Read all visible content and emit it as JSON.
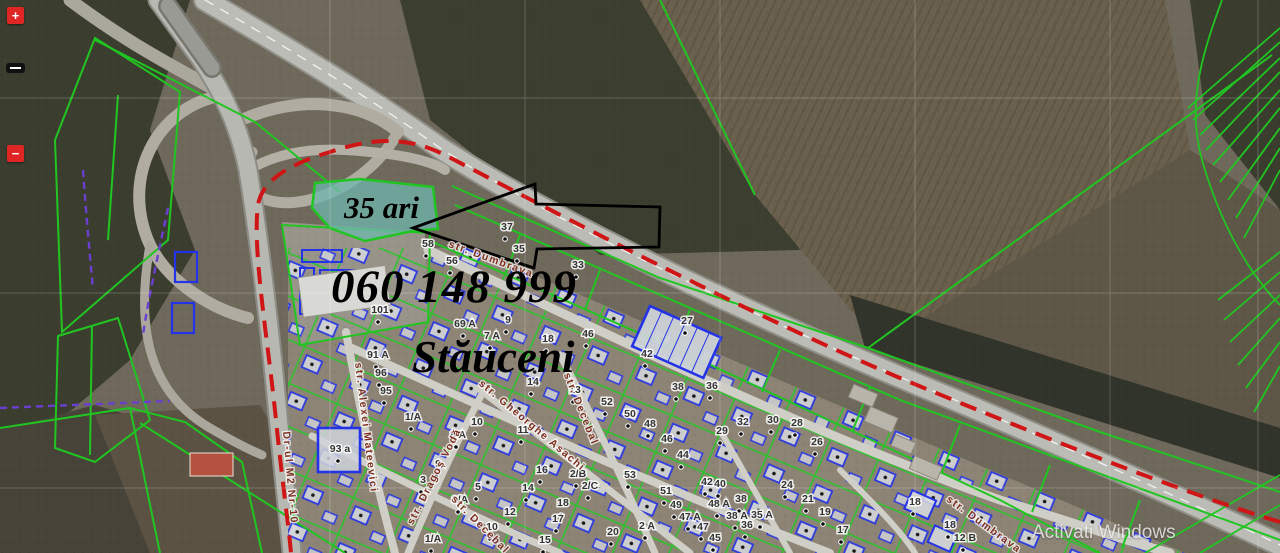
{
  "map": {
    "area_label": "35 ari",
    "phone_number": "060 148 999",
    "town_name": "Stăuceni",
    "watermark": "Activati Windows",
    "controls": {
      "zoom_in": "+",
      "zoom_out": "−"
    },
    "colors": {
      "cadastral_green": "#21c521",
      "building_blue": "#2433e8",
      "boundary_red": "#cf1515",
      "boundary_purple": "#6a3fd0",
      "highlight_teal": "#6fb7ae",
      "street_label": "#7d2f1f"
    },
    "street_labels": [
      {
        "text": "str. Dumbrava",
        "x": 490,
        "y": 262,
        "rot": 20
      },
      {
        "text": "str. Dumbrava",
        "x": 982,
        "y": 527,
        "rot": 36
      },
      {
        "text": "str. Alexei Mateevici",
        "x": 363,
        "y": 428,
        "rot": 83
      },
      {
        "text": "str. Dragoș Vodă",
        "x": 437,
        "y": 478,
        "rot": -63
      },
      {
        "text": "str. Gheorghe Asachi",
        "x": 530,
        "y": 428,
        "rot": 40
      },
      {
        "text": "str. Decebal",
        "x": 578,
        "y": 410,
        "rot": 68
      },
      {
        "text": "str. Decebal",
        "x": 478,
        "y": 527,
        "rot": 45
      },
      {
        "text": "Dr-ul M2 Nr-10",
        "x": 287,
        "y": 478,
        "rot": 85
      }
    ],
    "parcel_labels": [
      {
        "text": "58",
        "x": 428,
        "y": 247
      },
      {
        "text": "56",
        "x": 452,
        "y": 264
      },
      {
        "text": "37",
        "x": 507,
        "y": 230
      },
      {
        "text": "35",
        "x": 519,
        "y": 252
      },
      {
        "text": "33",
        "x": 578,
        "y": 268
      },
      {
        "text": "27",
        "x": 687,
        "y": 324
      },
      {
        "text": "42",
        "x": 647,
        "y": 357
      },
      {
        "text": "38",
        "x": 678,
        "y": 390
      },
      {
        "text": "36",
        "x": 712,
        "y": 389
      },
      {
        "text": "101",
        "x": 380,
        "y": 313
      },
      {
        "text": "69 A",
        "x": 465,
        "y": 327
      },
      {
        "text": "7 A",
        "x": 492,
        "y": 339
      },
      {
        "text": "9",
        "x": 508,
        "y": 323
      },
      {
        "text": "18",
        "x": 548,
        "y": 342
      },
      {
        "text": "46",
        "x": 588,
        "y": 337
      },
      {
        "text": "91 A",
        "x": 378,
        "y": 358
      },
      {
        "text": "96",
        "x": 381,
        "y": 376
      },
      {
        "text": "95",
        "x": 386,
        "y": 394
      },
      {
        "text": "93 a",
        "x": 340,
        "y": 452
      },
      {
        "text": "1/A",
        "x": 413,
        "y": 420
      },
      {
        "text": "10",
        "x": 477,
        "y": 425
      },
      {
        "text": "8 A",
        "x": 458,
        "y": 438
      },
      {
        "text": "9",
        "x": 438,
        "y": 467
      },
      {
        "text": "5",
        "x": 478,
        "y": 490
      },
      {
        "text": "3/A",
        "x": 460,
        "y": 503
      },
      {
        "text": "3",
        "x": 423,
        "y": 483
      },
      {
        "text": "1/A",
        "x": 433,
        "y": 542
      },
      {
        "text": "14",
        "x": 533,
        "y": 385
      },
      {
        "text": "13",
        "x": 575,
        "y": 393
      },
      {
        "text": "52",
        "x": 607,
        "y": 405
      },
      {
        "text": "50",
        "x": 630,
        "y": 417
      },
      {
        "text": "48",
        "x": 650,
        "y": 427
      },
      {
        "text": "46",
        "x": 667,
        "y": 442
      },
      {
        "text": "44",
        "x": 683,
        "y": 458
      },
      {
        "text": "29",
        "x": 722,
        "y": 434
      },
      {
        "text": "32",
        "x": 743,
        "y": 425
      },
      {
        "text": "30",
        "x": 773,
        "y": 423
      },
      {
        "text": "28",
        "x": 797,
        "y": 426
      },
      {
        "text": "26",
        "x": 817,
        "y": 445
      },
      {
        "text": "11",
        "x": 523,
        "y": 433
      },
      {
        "text": "16",
        "x": 542,
        "y": 473
      },
      {
        "text": "14",
        "x": 528,
        "y": 491
      },
      {
        "text": "12",
        "x": 510,
        "y": 515
      },
      {
        "text": "2/B",
        "x": 578,
        "y": 477
      },
      {
        "text": "2/C",
        "x": 590,
        "y": 489
      },
      {
        "text": "18",
        "x": 563,
        "y": 506
      },
      {
        "text": "17",
        "x": 558,
        "y": 522
      },
      {
        "text": "15",
        "x": 545,
        "y": 543
      },
      {
        "text": "53",
        "x": 630,
        "y": 478
      },
      {
        "text": "51",
        "x": 666,
        "y": 494
      },
      {
        "text": "49",
        "x": 676,
        "y": 508
      },
      {
        "text": "42",
        "x": 707,
        "y": 485
      },
      {
        "text": "40",
        "x": 720,
        "y": 487
      },
      {
        "text": "48 A",
        "x": 719,
        "y": 507
      },
      {
        "text": "38",
        "x": 741,
        "y": 502
      },
      {
        "text": "47 A",
        "x": 690,
        "y": 520
      },
      {
        "text": "38 A",
        "x": 737,
        "y": 519
      },
      {
        "text": "36",
        "x": 747,
        "y": 528
      },
      {
        "text": "35 A",
        "x": 762,
        "y": 518
      },
      {
        "text": "24",
        "x": 787,
        "y": 488
      },
      {
        "text": "21",
        "x": 808,
        "y": 502
      },
      {
        "text": "19",
        "x": 825,
        "y": 515
      },
      {
        "text": "17",
        "x": 843,
        "y": 533
      },
      {
        "text": "47",
        "x": 703,
        "y": 530
      },
      {
        "text": "45",
        "x": 715,
        "y": 541
      },
      {
        "text": "20",
        "x": 613,
        "y": 535
      },
      {
        "text": "2 A",
        "x": 647,
        "y": 529
      },
      {
        "text": "10",
        "x": 492,
        "y": 530
      },
      {
        "text": "18",
        "x": 915,
        "y": 505
      },
      {
        "text": "18",
        "x": 950,
        "y": 528
      },
      {
        "text": "12 B",
        "x": 965,
        "y": 541
      }
    ]
  }
}
